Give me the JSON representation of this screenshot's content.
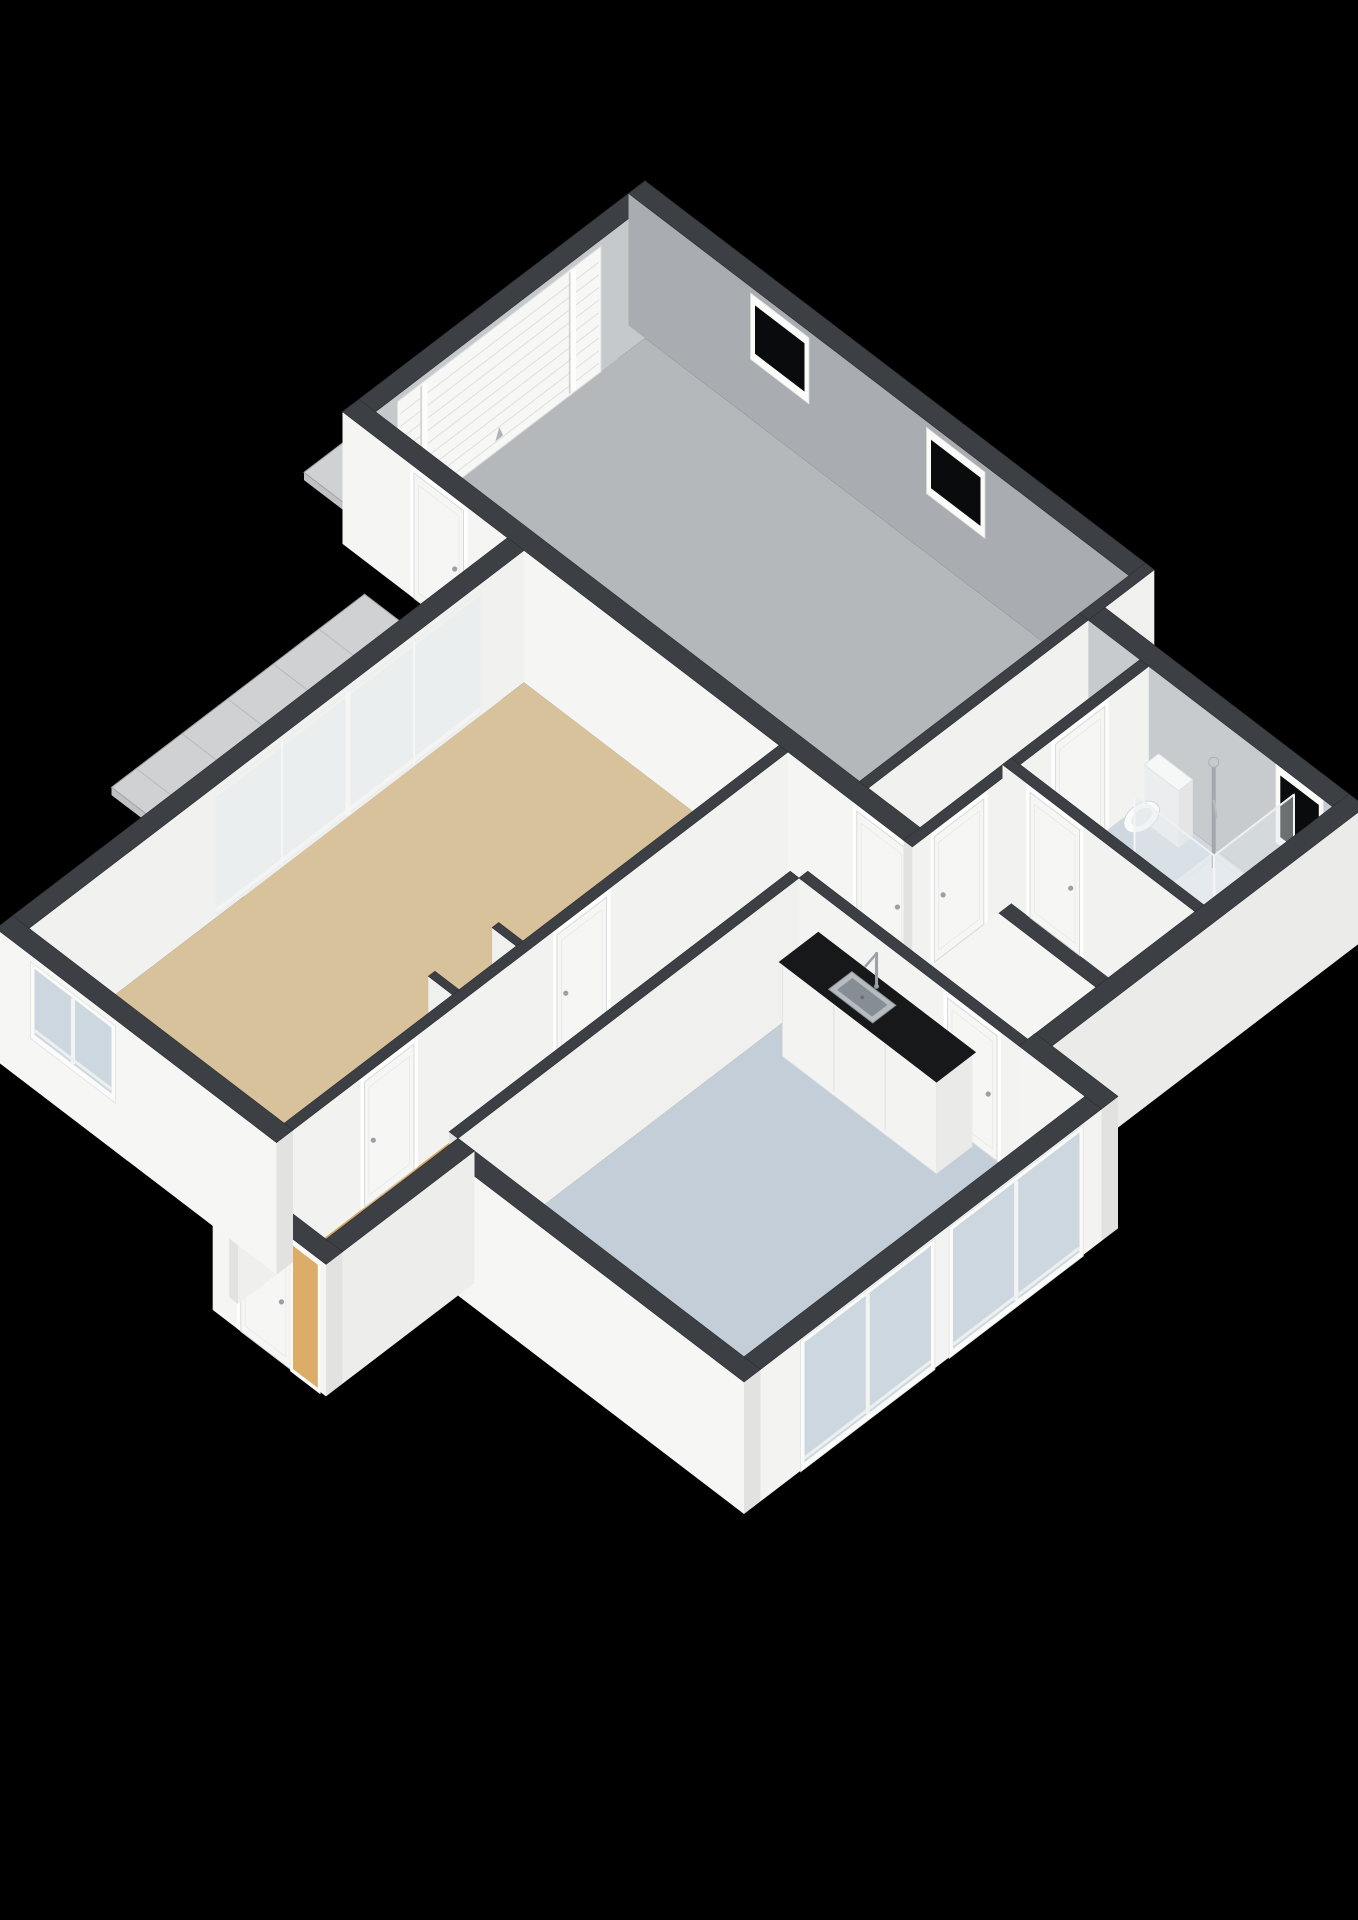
{
  "scene": {
    "projection": {
      "A": 55,
      "B": 42,
      "H": 110,
      "cx": 645,
      "cy": 338,
      "cutHeight": 1.2
    },
    "palette": {
      "background": "#000000",
      "wallTop": "#3c3f43",
      "wallTopStroke": "#2b2e31",
      "capFace": "#e2e2e0",
      "garageWall": "#a9adb1",
      "bathWall": "#c7cbce",
      "garageFloor": "#b5b8ba",
      "livingFloor": "#d7c29c",
      "hallFloor": "#d9a55c",
      "kitchenFloor": "#c4ced8",
      "bathFloor": "#cfd8e1",
      "terrace": "#cfd1d2",
      "terraceLine": "#b7babc",
      "terraceEdge": "#aeb1b3",
      "glassDark": "#0a0b0c",
      "glassLight": "#ccd7e0",
      "glassPale": "rgba(228,234,238,0.45)",
      "frameWhite": "#fbfbf9",
      "doorPanel": "#f6f6f4",
      "doorStroke": "#d7d9da",
      "counterTop": "#17181a",
      "cabinet": "#f3f3f1",
      "steel": "#b6bcc0",
      "steelDark": "#878e93",
      "chrome": "#a3a8ac",
      "hob": "#2b2d2f",
      "flame": "#c96b2f",
      "matWhite": "rgba(255,255,255,0.94)"
    },
    "elements": [
      {
        "kind": "terrace",
        "id": "terrace",
        "x1": 0.5,
        "y1": 5.6,
        "x2": 3.0,
        "y2": 10.2,
        "edges": [
          "x1",
          "y2"
        ]
      },
      {
        "kind": "terrace",
        "id": "garage-apron",
        "x1": -1.5,
        "y1": 0.5,
        "x2": 0.0,
        "y2": 4.7,
        "edges": [
          "x1",
          "y2"
        ]
      },
      {
        "kind": "floor",
        "id": "room-garage",
        "color": "garageFloor",
        "poly": [
          [
            0,
            0
          ],
          [
            8.8,
            0
          ],
          [
            8.8,
            5.2
          ],
          [
            0,
            5.2
          ]
        ]
      },
      {
        "kind": "floor",
        "id": "room-lobby",
        "color": "hallFloor",
        "poly": [
          [
            8.8,
            0.9
          ],
          [
            9.9,
            0.9
          ],
          [
            9.9,
            5.2
          ],
          [
            8.8,
            5.2
          ]
        ]
      },
      {
        "kind": "floor",
        "id": "room-bathroom",
        "color": "bathFloor",
        "poly": [
          [
            9.9,
            0.9
          ],
          [
            13.4,
            0.9
          ],
          [
            13.4,
            3.4
          ],
          [
            9.9,
            3.4
          ]
        ]
      },
      {
        "kind": "floor",
        "id": "room-toilet",
        "color": "bathFloor",
        "poly": [
          [
            9.9,
            3.4
          ],
          [
            13.4,
            3.4
          ],
          [
            13.4,
            5.2
          ],
          [
            9.9,
            5.2
          ]
        ]
      },
      {
        "kind": "floor",
        "id": "room-living",
        "color": "livingFloor",
        "poly": [
          [
            3.0,
            5.2
          ],
          [
            7.8,
            5.2
          ],
          [
            7.8,
            14.2
          ],
          [
            3.0,
            14.2
          ]
        ]
      },
      {
        "kind": "floor",
        "id": "room-hall",
        "color": "hallFloor",
        "poly": [
          [
            7.8,
            5.2
          ],
          [
            13.4,
            5.2
          ],
          [
            13.4,
            6.6
          ],
          [
            9.4,
            6.6
          ],
          [
            9.4,
            15.2
          ],
          [
            7.8,
            15.2
          ]
        ]
      },
      {
        "kind": "floor",
        "id": "room-kitchen",
        "color": "kitchenFloor",
        "poly": [
          [
            9.4,
            6.6
          ],
          [
            14.6,
            6.6
          ],
          [
            14.6,
            12.8
          ],
          [
            9.4,
            12.8
          ]
        ]
      },
      {
        "kind": "wall",
        "id": "wall-garage-nw",
        "orient": "y",
        "at": 0,
        "from": 0,
        "to": 5.2,
        "t": 0.3,
        "out": -1,
        "face": "#c6c9cb",
        "features": [
          {
            "type": "garage-door",
            "name": "garage-door",
            "from": 0.8,
            "to": 4.5,
            "z1": 0,
            "z2": 1.14
          }
        ]
      },
      {
        "kind": "wall",
        "id": "wall-garage-ne",
        "orient": "x",
        "at": 0,
        "from": -0.3,
        "to": 8.8,
        "t": 0.3,
        "out": -1,
        "face": "#a9adb1",
        "features": [
          {
            "type": "window",
            "name": "garage-window-1",
            "from": 2.0,
            "to": 2.9,
            "z1": 0.62,
            "z2": 1.06,
            "glass": "dark"
          },
          {
            "type": "window",
            "name": "garage-window-2",
            "from": 5.2,
            "to": 6.1,
            "z1": 0.62,
            "z2": 1.06,
            "glass": "dark"
          }
        ]
      },
      {
        "kind": "wall",
        "id": "wall-step-ne",
        "orient": "y",
        "at": 8.8,
        "from": -0.3,
        "to": 0.9,
        "t": 0.16,
        "out": 1,
        "face": "#f0f0ee"
      },
      {
        "kind": "wall",
        "id": "wall-bath-ne",
        "orient": "x",
        "at": 0.9,
        "from": 8.96,
        "to": 13.4,
        "t": 0.3,
        "out": -1,
        "face": "#c7cbce",
        "features": [
          {
            "type": "window",
            "name": "bathroom-window",
            "from": 12.45,
            "to": 13.15,
            "z1": 0.56,
            "z2": 1.12,
            "glass": "dark"
          }
        ]
      },
      {
        "kind": "wall",
        "id": "wall-garage-lobby",
        "orient": "y",
        "at": 8.8,
        "from": 0.9,
        "to": 5.2,
        "t": 0.16,
        "out": 1,
        "face": "#f1f1ef"
      },
      {
        "kind": "wall",
        "id": "wall-spine",
        "orient": "x",
        "at": 5.2,
        "from": -0.3,
        "to": 13.4,
        "t": 0.3,
        "out": -1,
        "face": "#f5f5f3",
        "features": [
          {
            "type": "door",
            "name": "terrace-door",
            "from": 1.0,
            "to": 1.9
          },
          {
            "type": "door",
            "name": "lobby-door",
            "from": 9.05,
            "to": 9.95
          }
        ]
      },
      {
        "kind": "wall",
        "id": "wall-lobby-bath",
        "orient": "y",
        "at": 9.9,
        "from": 0.9,
        "to": 5.2,
        "t": 0.16,
        "out": 1,
        "face": "#f2f2f0",
        "features": [
          {
            "type": "door",
            "name": "bathroom-door",
            "from": 1.7,
            "to": 2.6
          },
          {
            "type": "door",
            "name": "toilet-room-door",
            "from": 3.9,
            "to": 4.8
          }
        ]
      },
      {
        "kind": "toilet",
        "id": "toilet"
      },
      {
        "kind": "shower",
        "id": "shower-cabin"
      },
      {
        "kind": "radiator",
        "id": "radiator"
      },
      {
        "kind": "wall",
        "id": "wall-bath-toilet",
        "orient": "x",
        "at": 3.4,
        "from": 9.9,
        "to": 13.4,
        "t": 0.16,
        "out": -1,
        "face": "#f2f2f0",
        "features": [
          {
            "type": "door",
            "name": "toilet-door",
            "from": 10.4,
            "to": 11.3
          }
        ]
      },
      {
        "kind": "wall",
        "id": "wall-bath-se",
        "orient": "y",
        "at": 13.4,
        "from": 0.6,
        "to": 6.6,
        "t": 0.3,
        "out": 1,
        "face": "#ebebe9"
      },
      {
        "kind": "stove",
        "id": "stove"
      },
      {
        "kind": "wall",
        "id": "wall-living-hall",
        "orient": "y",
        "at": 7.8,
        "from": 5.2,
        "to": 14.2,
        "t": 0.16,
        "out": -1,
        "face": "#f2f2f0",
        "features": [
          {
            "type": "door",
            "name": "living-door-1",
            "from": 8.5,
            "to": 9.4
          },
          {
            "type": "door",
            "name": "living-door-2",
            "from": 12.0,
            "to": 12.9
          }
        ]
      },
      {
        "kind": "wall",
        "id": "wall-living-nw",
        "orient": "y",
        "at": 3.0,
        "from": 5.2,
        "to": 14.2,
        "t": 0.3,
        "out": -1,
        "face": "#f1f1ef",
        "features": [
          {
            "type": "sliding-window",
            "name": "living-sliding-window",
            "from": 6.0,
            "to": 10.8,
            "z1": 0.02,
            "z2": 1.14
          }
        ]
      },
      {
        "kind": "wall",
        "id": "wall-hall-kitchen-ne",
        "orient": "x",
        "at": 6.6,
        "from": 9.4,
        "to": 13.4,
        "t": 0.16,
        "out": -1,
        "face": "#f3f3f1",
        "features": [
          {
            "type": "door",
            "name": "kitchen-door",
            "from": 12.1,
            "to": 13.0
          }
        ]
      },
      {
        "kind": "wall",
        "id": "wall-hall-kitchen",
        "orient": "y",
        "at": 9.4,
        "from": 6.6,
        "to": 12.8,
        "t": 0.16,
        "out": -1,
        "face": "#f0f0ee"
      },
      {
        "kind": "counter",
        "id": "kitchen-counter"
      },
      {
        "kind": "wall",
        "id": "wall-kitchen-step",
        "orient": "x",
        "at": 6.6,
        "from": 13.4,
        "to": 14.9,
        "t": 0.3,
        "out": -1,
        "face": "#f4f4f2"
      },
      {
        "kind": "mat",
        "id": "kitchen-mat"
      },
      {
        "kind": "wall",
        "id": "wall-kitchen-se",
        "orient": "y",
        "at": 14.6,
        "from": 6.6,
        "to": 12.8,
        "t": 0.3,
        "out": 1,
        "face": "#f3f3f1",
        "features": [
          {
            "type": "window-light",
            "name": "kitchen-window-1",
            "from": 7.0,
            "to": 9.3,
            "z1": 0.05,
            "z2": 1.14
          },
          {
            "type": "window-light",
            "name": "kitchen-window-2",
            "from": 9.7,
            "to": 12.0,
            "z1": 0.05,
            "z2": 1.14
          }
        ]
      },
      {
        "kind": "wall",
        "id": "wall-kitchen-sw",
        "orient": "x",
        "at": 12.8,
        "from": 9.4,
        "to": 14.9,
        "t": 0.3,
        "out": 1,
        "face": "#f6f6f4"
      },
      {
        "kind": "wall",
        "id": "wall-step-sw",
        "orient": "y",
        "at": 9.4,
        "from": 12.8,
        "to": 15.2,
        "t": 0.3,
        "out": 1,
        "face": "#ededeb"
      },
      {
        "kind": "wall",
        "id": "wall-hall-sw",
        "orient": "x",
        "at": 15.2,
        "from": 7.64,
        "to": 9.7,
        "t": 0.3,
        "out": 1,
        "face": "#f5f5f3",
        "features": [
          {
            "type": "door",
            "name": "front-door",
            "from": 8.15,
            "to": 9.05
          },
          {
            "type": "glass-side",
            "name": "front-door-sidelight",
            "from": 9.1,
            "to": 9.55,
            "z1": 0.02,
            "z2": 1.14,
            "fill": "#d9a55c"
          }
        ]
      },
      {
        "kind": "wall",
        "id": "wall-step-living",
        "orient": "y",
        "at": 7.8,
        "from": 14.2,
        "to": 15.2,
        "t": 0.16,
        "out": -1,
        "face": "#efefed"
      },
      {
        "kind": "wall",
        "id": "wall-living-sw",
        "orient": "x",
        "at": 14.2,
        "from": 2.7,
        "to": 7.8,
        "t": 0.3,
        "out": 1,
        "face": "#f6f6f4",
        "features": [
          {
            "type": "window-light",
            "name": "living-window",
            "from": 3.4,
            "to": 4.8,
            "z1": 0.5,
            "z2": 1.1
          }
        ]
      }
    ],
    "fixtures": {
      "toilet": {
        "x1": 10.3,
        "y1": 0.96,
        "x2": 10.92,
        "y2": 1.22,
        "h": 0.52,
        "bowlX": 10.61,
        "bowlY": 1.58
      },
      "shower": {
        "x1": 11.3,
        "y1": 0.95,
        "x2": 12.75,
        "y2": 2.4,
        "h": 1.08,
        "colX": 11.48,
        "colY": 1.14
      },
      "radiator": {
        "x": 13.32,
        "y1": 1.5,
        "y2": 3.1,
        "z1": 0.22,
        "z2": 1.02,
        "fins": 7
      },
      "counter": {
        "x1": 9.8,
        "y1": 6.65,
        "x2": 12.6,
        "y2": 7.3,
        "h": 0.86,
        "sink": {
          "x1": 10.55,
          "y1": 6.79,
          "x2": 11.35,
          "y2": 7.21
        },
        "faucetX": 10.95,
        "faucetY": 6.74
      },
      "stove": {
        "stubX1": 7.2,
        "stubX2": 7.64,
        "stubYa": 9.98,
        "stubYb": 11.14,
        "x1": 7.26,
        "y1": 10.08,
        "x2": 7.62,
        "y2": 10.92,
        "h": 0.85
      },
      "mat": {
        "x1": 13.55,
        "y1": 10.95,
        "x2": 14.45,
        "y2": 12.6
      }
    }
  }
}
